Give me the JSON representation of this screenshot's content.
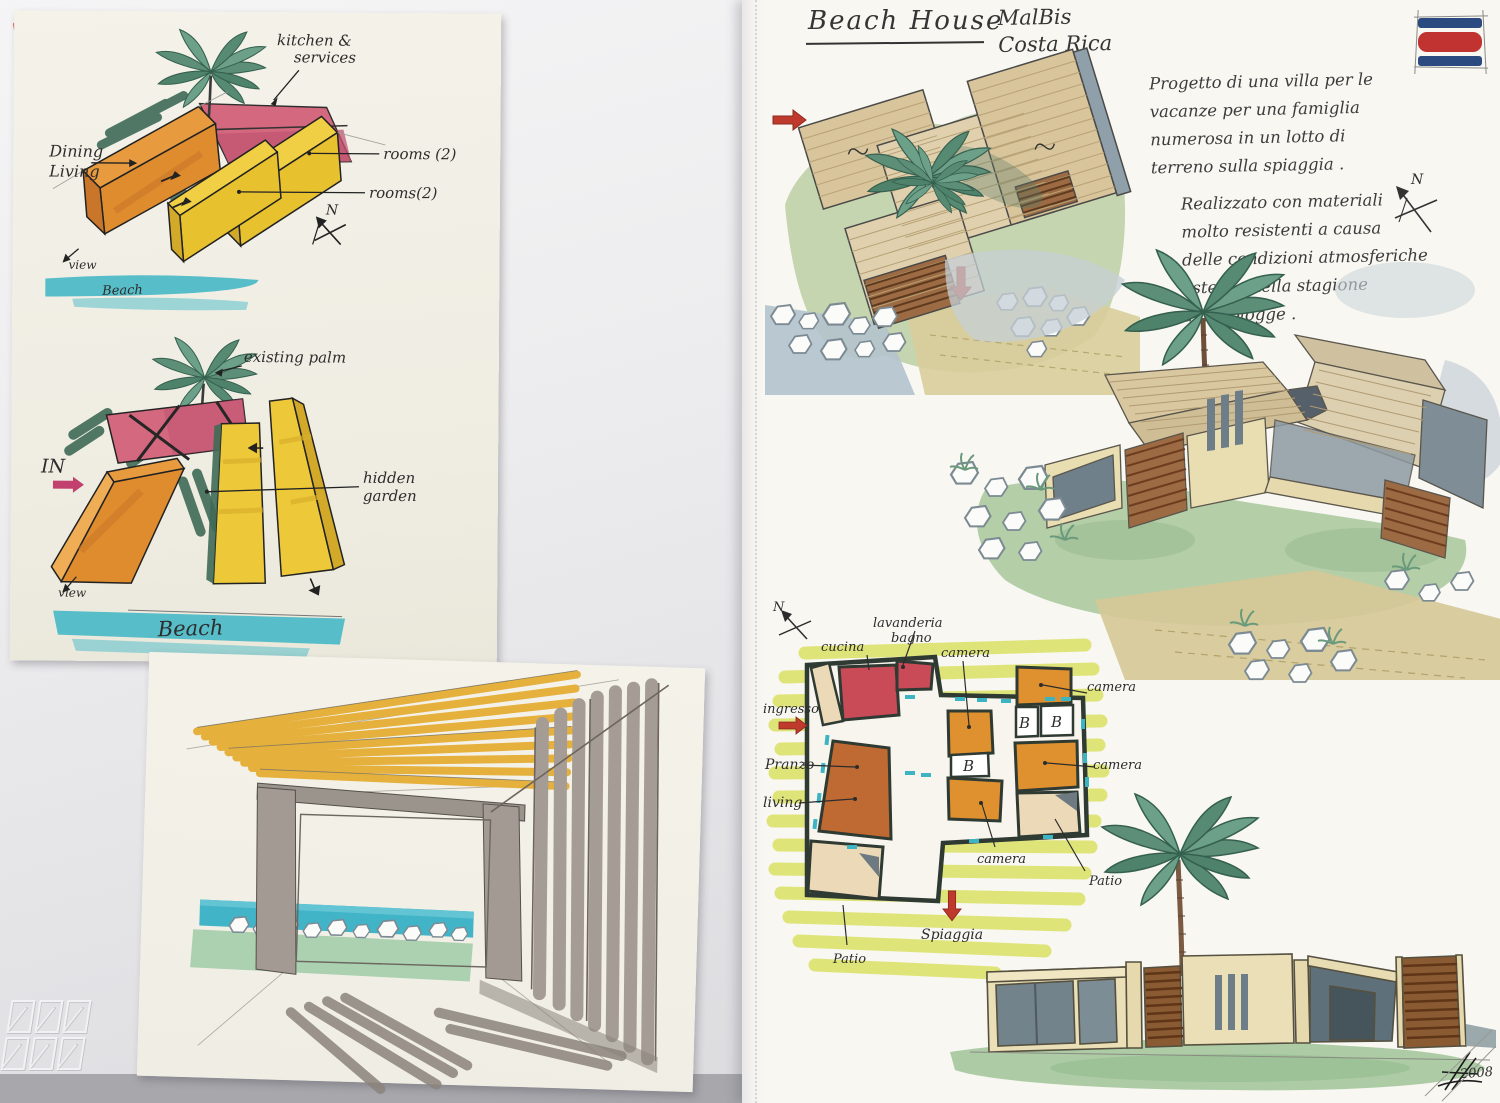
{
  "colors": {
    "marker_orange": "#e2912f",
    "marker_pink": "#d4687f",
    "marker_yellow": "#eecb3c",
    "marker_teal": "#54bcc9",
    "palm_green": "#5d8f78",
    "shadow_green": "#3f6a57",
    "red_arrow": "#bf3a2c",
    "highlighter": "#dde36c",
    "lawn_green": "#aecaa2",
    "wood_tan": "#d9c79f",
    "louver_brown": "#8a5a33",
    "wall_cream": "#eadfb6",
    "glass_gray": "#73838c",
    "ink": "#2d2d2d"
  },
  "left_page": {
    "massing_sketch_top": {
      "kitchen_label_1": "kitchen &",
      "kitchen_label_2": "services",
      "dining_label_1": "Dining",
      "dining_label_2": "Living",
      "rooms_label_a": "rooms (2)",
      "rooms_label_b": "rooms(2)",
      "view_label": "view",
      "beach_label": "Beach",
      "north_label": "N"
    },
    "massing_sketch_bottom": {
      "existing_palm_label": "existing palm",
      "in_label": "IN",
      "hidden_garden_label_1": "hidden",
      "hidden_garden_label_2": "garden",
      "view_label": "view",
      "beach_label": "Beach"
    }
  },
  "right_page": {
    "title": "Beach House",
    "location_line1": "MalBis",
    "location_line2": "Costa Rica",
    "description_1": [
      "Progetto di una villa per le",
      "vacanze per una famiglia",
      "numerosa in un lotto di",
      "terreno sulla spiaggia ."
    ],
    "description_2": [
      "Realizzato con materiali",
      "molto resistenti a causa",
      "delle condizioni atmosferiche",
      "esterne nella stagione",
      "delle piogge ."
    ],
    "aerial_north_label": "N",
    "floor_plan": {
      "north_label": "N",
      "laundry_label_1": "lavanderia",
      "laundry_label_2": "bagno",
      "kitchen_label": "cucina",
      "bedroom_label_top": "camera",
      "bedroom_label_right_top": "camera",
      "bedroom_label_right": "camera",
      "bedroom_label_bottom": "camera",
      "bath_label_1": "B",
      "bath_label_2": "B",
      "bath_label_3": "B",
      "entrance_label": "ingresso",
      "dining_label": "Pranzo",
      "living_label": "living",
      "patio_label_left": "Patio",
      "patio_label_right": "Patio",
      "beach_label": "Spiaggia"
    },
    "year": "2008"
  }
}
